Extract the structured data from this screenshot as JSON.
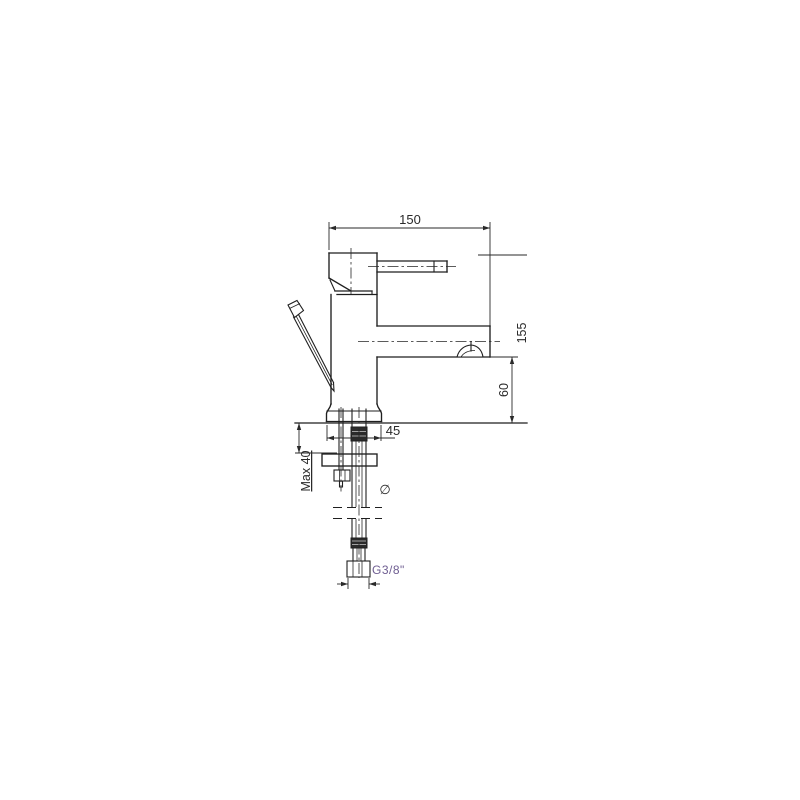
{
  "drawing": {
    "type": "technical-diagram",
    "subject": "single-lever basin mixer tap, side elevation with mounting hardware and flexible inlet hose",
    "background": "#ffffff",
    "colors": {
      "line": "#1f1f1f",
      "dimension": "#2a2a2a",
      "thread_label": "#6e5d91"
    },
    "dimensions": {
      "spout_reach": {
        "label": "150"
      },
      "overall_height": {
        "label": "155"
      },
      "spout_clearance": {
        "label": "60"
      },
      "base_width": {
        "label": "45"
      },
      "deck_thickness": {
        "label": "Max 40"
      },
      "inlet_thread": {
        "label": "G3/8\""
      },
      "diameter_symbol": "∅"
    }
  }
}
